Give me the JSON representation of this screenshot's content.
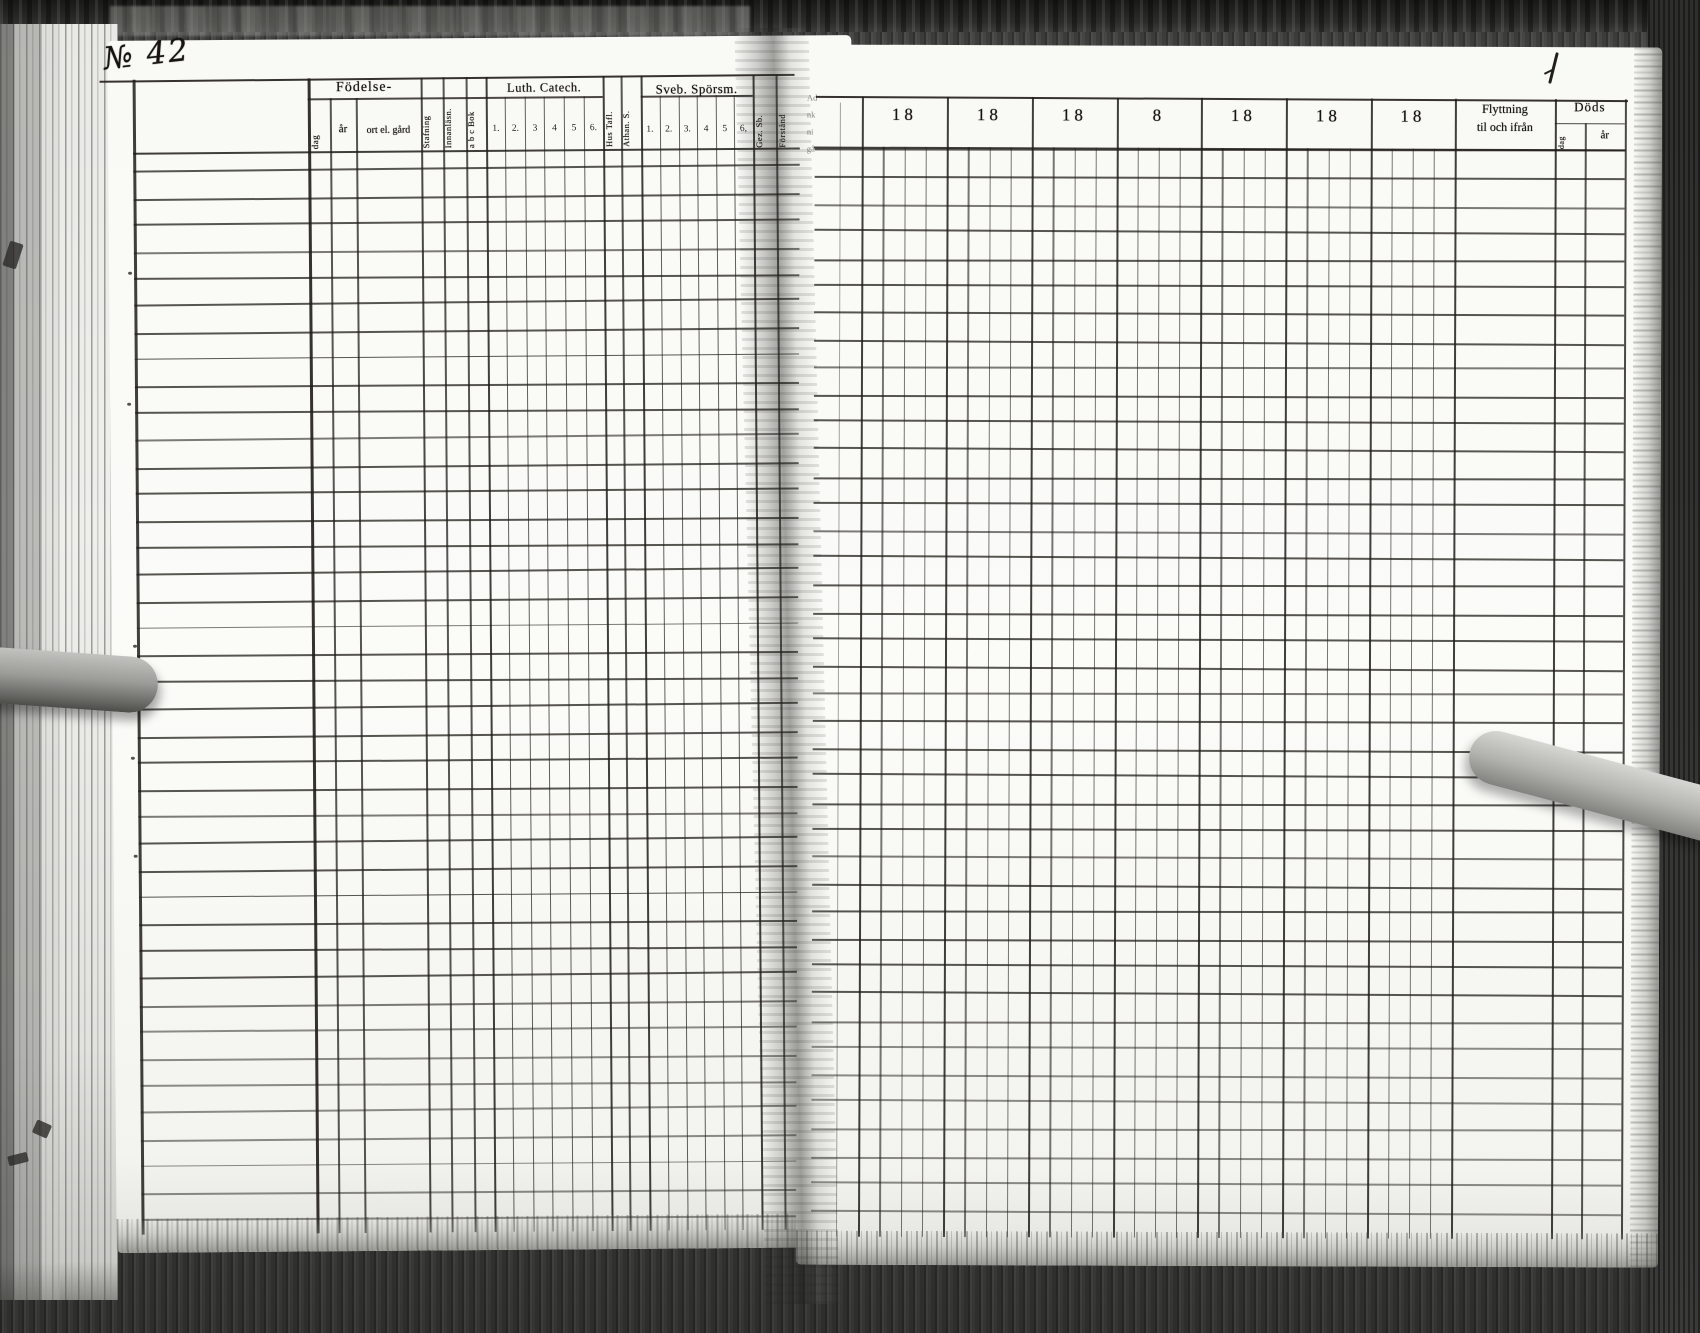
{
  "page": {
    "number_label": "№ 42"
  },
  "left_table": {
    "birth_group": {
      "label": "Födelse-",
      "columns": [
        "dag",
        "år",
        "ort el. gård"
      ]
    },
    "reading_columns": [
      "Stafning",
      "Innanläsn.",
      "a b c Bok"
    ],
    "luther_group": {
      "label": "Luth. Catech.",
      "columns": [
        "1.",
        "2.",
        "3",
        "4",
        "5",
        "6."
      ]
    },
    "creed_columns": [
      "Hus Tafl.",
      "Athan. S."
    ],
    "svebilius_group": {
      "label": "Sveb. Spörsm.",
      "columns": [
        "1.",
        "2.",
        "3.",
        "4",
        "5",
        "6,"
      ]
    },
    "understanding_columns": [
      "Gez. Sb.",
      "Förstånd"
    ],
    "gutter_fragments": [
      "Ad",
      "nk",
      "ni",
      "gå"
    ]
  },
  "right_table": {
    "year_headers": [
      "18",
      "18",
      "18",
      "8",
      "18",
      "18",
      "18"
    ],
    "moving_group": {
      "line1": "Flyttning",
      "line2": "til och ifrån"
    },
    "death_group": {
      "label": "Döds",
      "columns": [
        "dag",
        "år"
      ]
    }
  },
  "colors": {
    "ink": "#201d18",
    "paper": "#f9f9f6",
    "background": "#4d4d4b"
  }
}
